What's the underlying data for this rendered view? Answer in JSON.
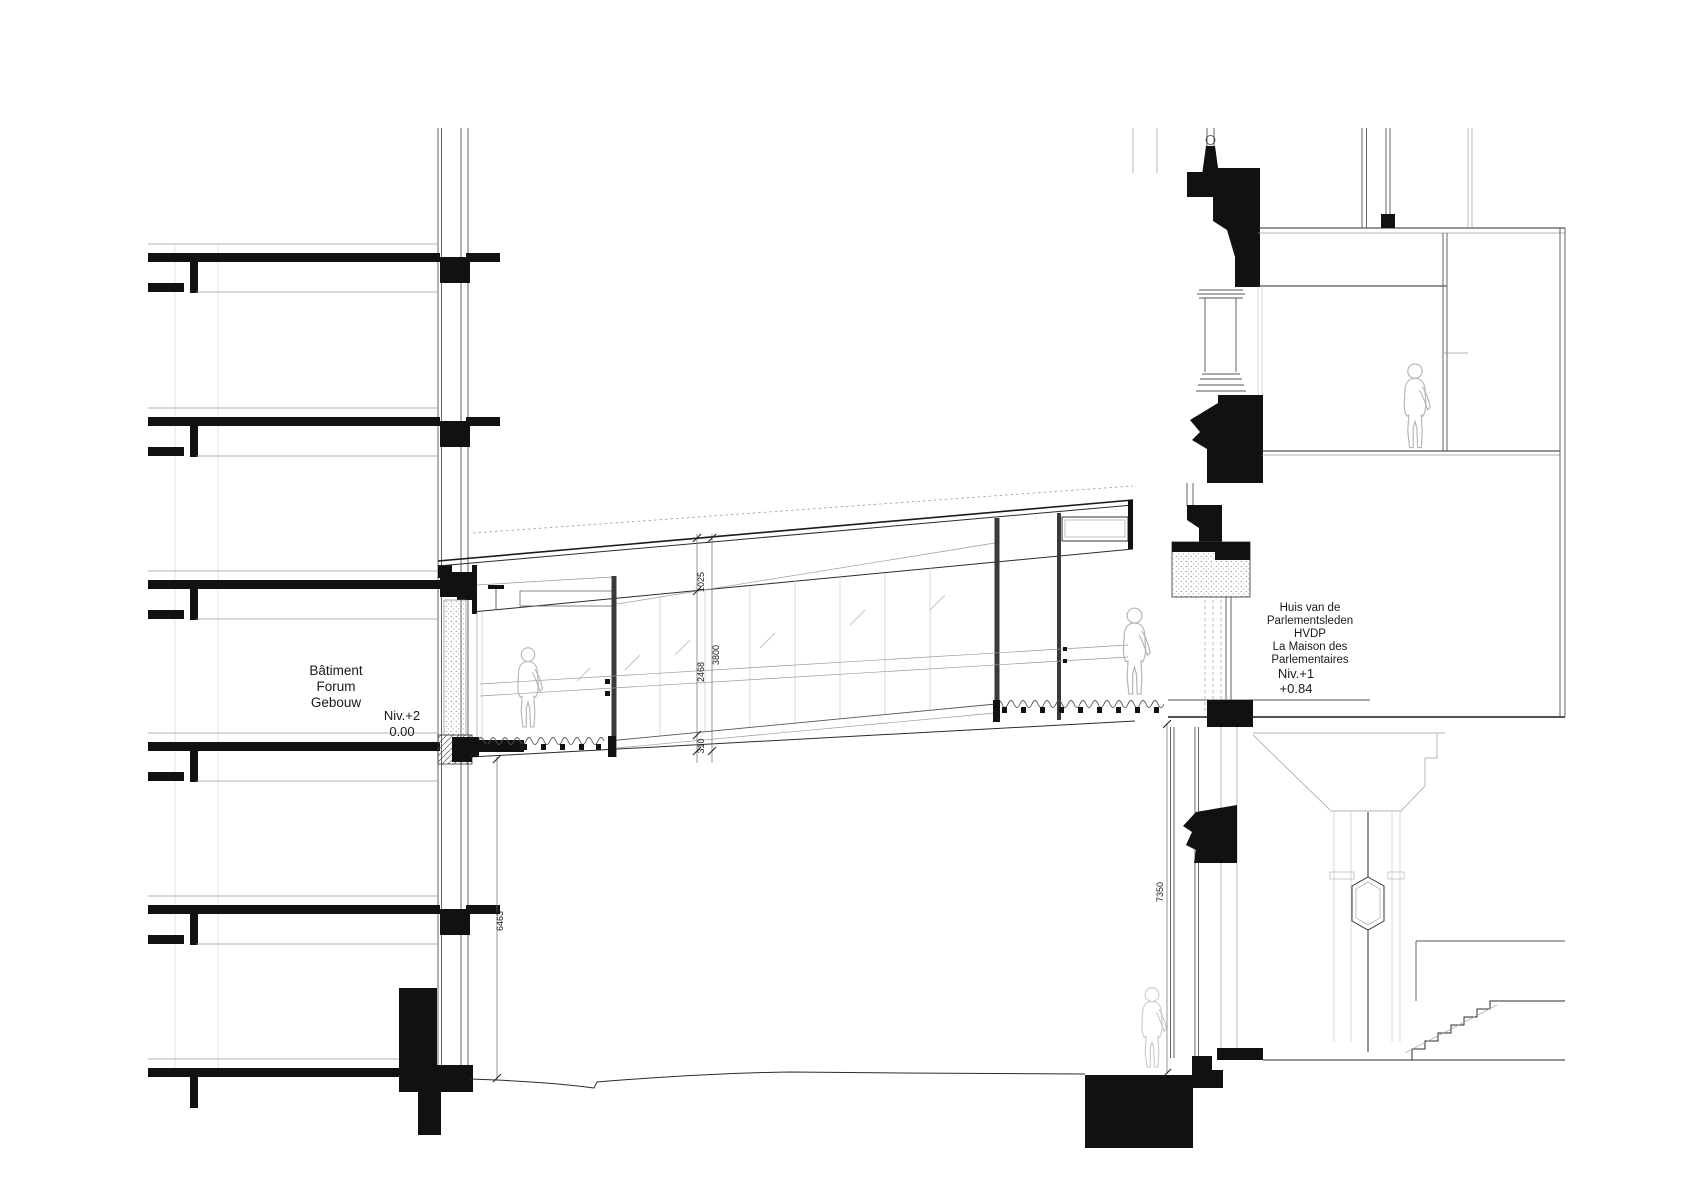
{
  "drawing_type": "architectural-section",
  "left_building": {
    "name_lines": [
      "Bâtiment",
      "Forum",
      "Gebouw"
    ],
    "level_label": "Niv.+2",
    "level_value": "0.00"
  },
  "right_building": {
    "name_lines": [
      "Huis van de",
      "Parlementsleden",
      "HVDP",
      "La Maison des",
      "Parlementaires"
    ],
    "level_label": "Niv.+1",
    "level_value": "+0.84"
  },
  "dimensions": {
    "bridge_roof_band": "1025",
    "bridge_glazing_height": "2468",
    "bridge_overall_height": "3800",
    "bridge_floor_depth": "310",
    "left_ground_clearance": "6463",
    "right_ground_clearance": "7350"
  },
  "colors": {
    "ink": "#111111",
    "paper": "#ffffff",
    "light_line": "#bbbbbb",
    "figure_outline": "#b5b5b5"
  }
}
